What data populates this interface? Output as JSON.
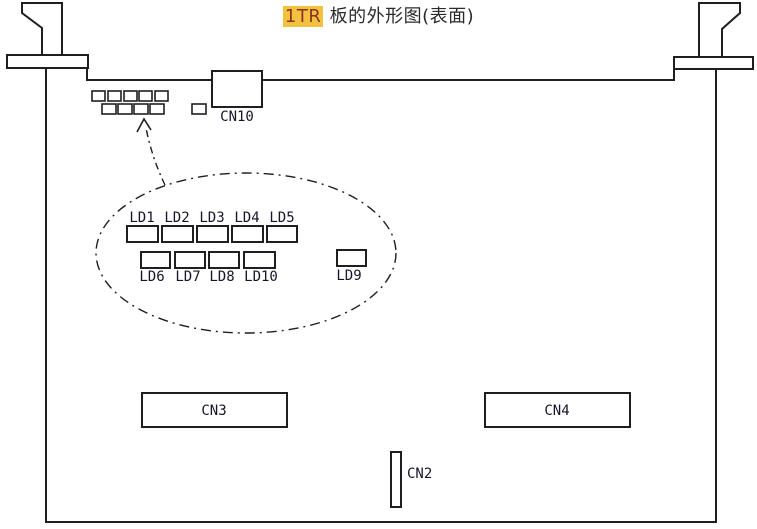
{
  "title": {
    "highlight": "1TR",
    "rest": " 板的外形图(表面)"
  },
  "colors": {
    "outline": "#1f1f1f",
    "label_text": "#16162a",
    "title_text": "#2b2b2b",
    "highlight_bg": "#f2c23e",
    "highlight_text": "#8c3224"
  },
  "connectors": {
    "cn10": "CN10",
    "cn3": "CN3",
    "cn4": "CN4",
    "cn2": "CN2"
  },
  "leds": {
    "top": [
      "LD1",
      "LD2",
      "LD3",
      "LD4",
      "LD5"
    ],
    "bottom": [
      "LD6",
      "LD7",
      "LD8",
      "LD10",
      "LD9"
    ]
  }
}
